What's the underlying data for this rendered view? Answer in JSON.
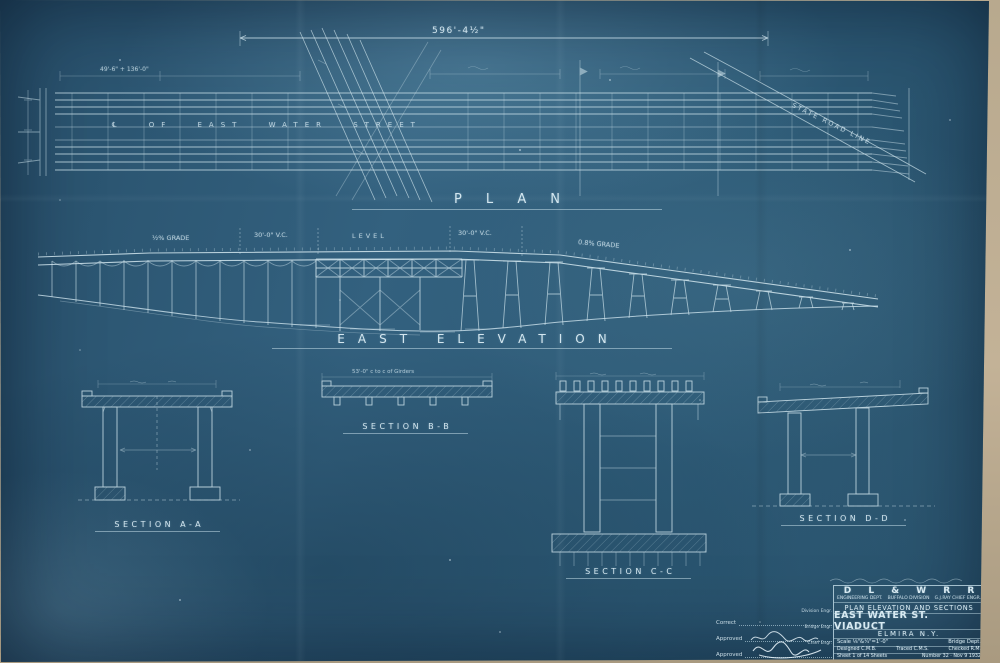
{
  "sheet": {
    "top_dimension": "596'-4½\"",
    "plan": {
      "label": "PLAN",
      "street_label": "℄ OF EAST WATER STREET",
      "road_label": "STATE ROAD LINE",
      "left_approach_dim": "49'-6\" + 136'-0\""
    },
    "elevation": {
      "label": "EAST ELEVATION",
      "grade_left": "½% GRADE",
      "vc_left": "30'-0\" V.C.",
      "level": "LEVEL",
      "vc_right": "30'-0\" V.C.",
      "grade_right": "0.8% GRADE"
    },
    "sections": {
      "a_label": "SECTION A-A",
      "b_label": "SECTION B-B",
      "c_label": "SECTION C-C",
      "d_label": "SECTION D-D",
      "b_note": "53'-0\" c to c of Girders"
    },
    "title_block": {
      "railroad": "D L & W R R",
      "dept": "ENGINEERING DEPT.",
      "division": "BUFFALO DIVISION",
      "chief": "G.J.RAY CHIEF ENGR.",
      "drawing_type": "PLAN ELEVATION AND SECTIONS",
      "title": "EAST WATER ST. VIADUCT",
      "location": "ELMIRA N.Y.",
      "scale": "Scale ⅛\"&¼\"=1'-0\"",
      "dept2": "Bridge Dept.",
      "designed": "Designed C.M.B.",
      "traced": "Traced C.M.S.",
      "checked": "Checked R.M.",
      "sheet_no": "Sheet 1 of 14 Sheets",
      "number": "Number 32 · Nov 9 1932"
    },
    "approvals": {
      "correct_label": "Correct",
      "correct_title": "Division Engr.",
      "approved1_label": "Approved",
      "approved1_title": "Bridge Engr.",
      "approved2_label": "Approved",
      "approved2_title": "Chief Engr."
    }
  }
}
